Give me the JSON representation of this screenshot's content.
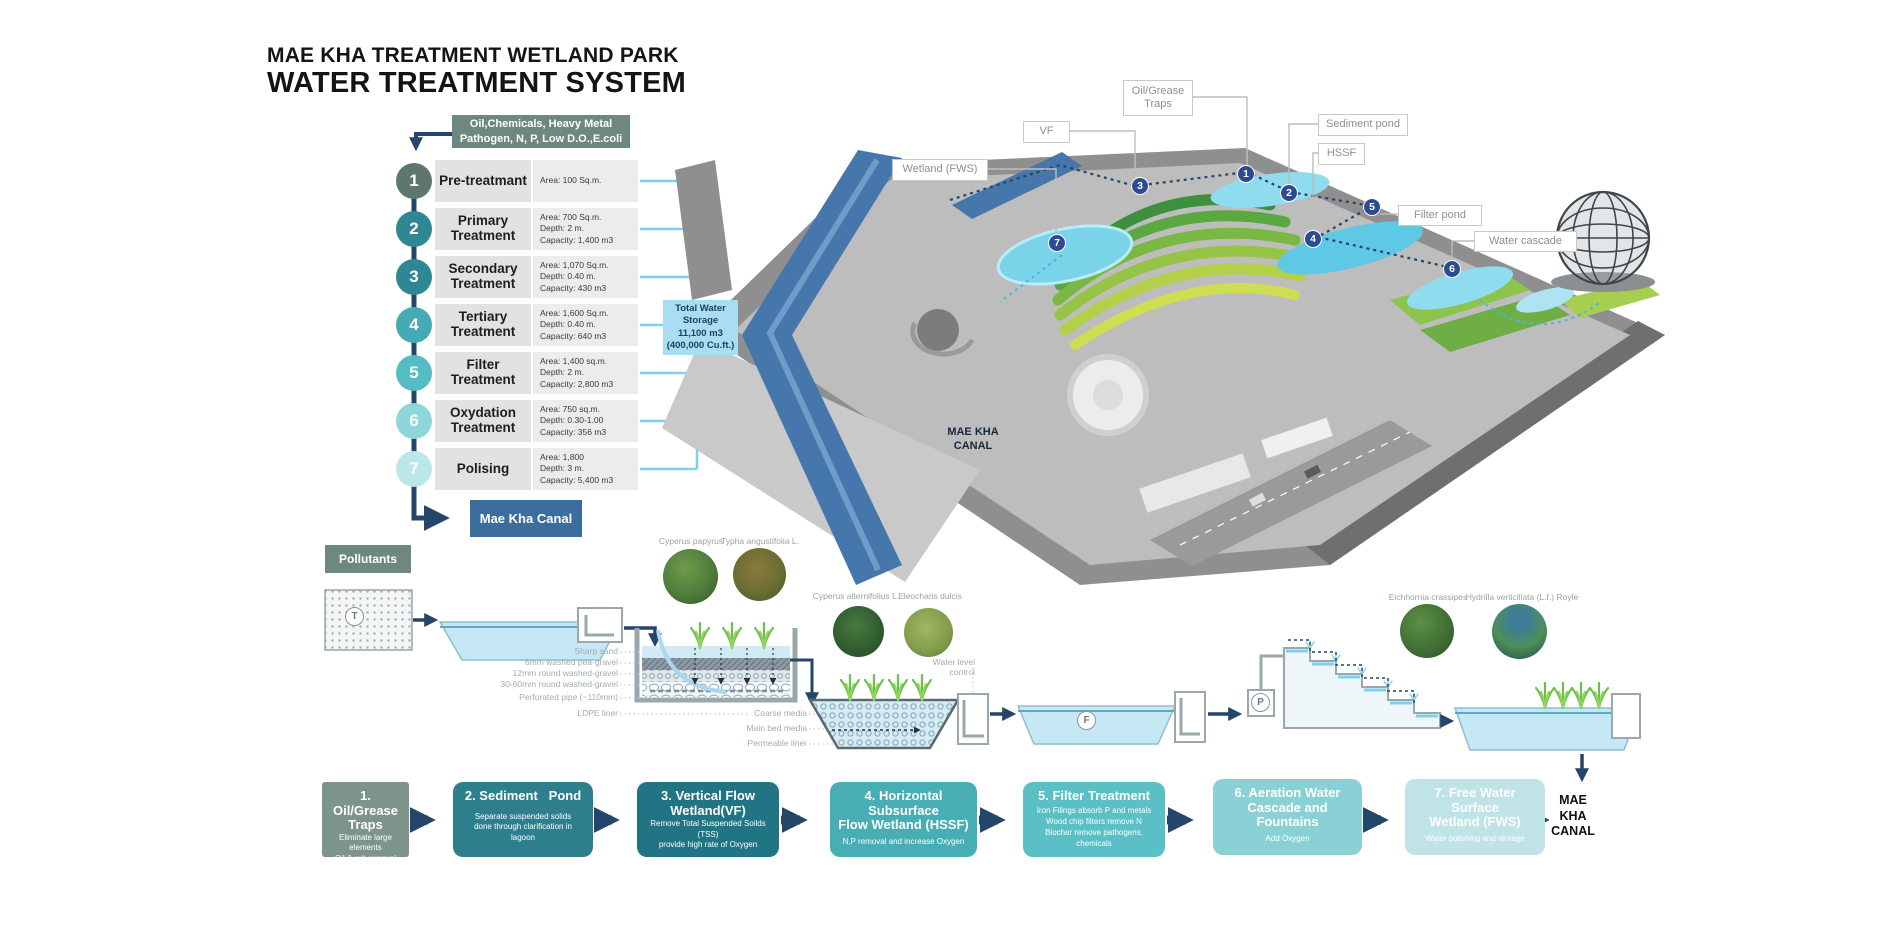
{
  "title": {
    "line1": "MAE KHA TREATMENT WETLAND PARK",
    "line2": "WATER TREATMENT SYSTEM"
  },
  "flowchart": {
    "input_box": "Oil,Chemicals, Heavy Metal\nPathogen, N, P, Low D.O.,E.coli",
    "steps": [
      {
        "num": "1",
        "name": "Pre-treatmant",
        "area": "Area: 100 Sq.m.",
        "depth": "",
        "capacity": "",
        "color": "#5e7670"
      },
      {
        "num": "2",
        "name": "Primary Treatment",
        "area": "Area: 700 Sq.m.",
        "depth": "Depth: 2 m.",
        "capacity": "Capacity: 1,400 m3",
        "color": "#2f8794"
      },
      {
        "num": "3",
        "name": "Secondary Treatment",
        "area": "Area: 1,070 Sq.m.",
        "depth": "Depth: 0.40 m.",
        "capacity": "Capacity: 430 m3",
        "color": "#2f8794"
      },
      {
        "num": "4",
        "name": "Tertiary Treatment",
        "area": "Area: 1,600 Sq.m.",
        "depth": "Depth: 0.40 m.",
        "capacity": "Capacity: 640 m3",
        "color": "#44aab4"
      },
      {
        "num": "5",
        "name": "Filter Treatment",
        "area": "Area: 1,400 sq.m.",
        "depth": "Depth: 2 m.",
        "capacity": "Capacity: 2,800 m3",
        "color": "#56bcc4"
      },
      {
        "num": "6",
        "name": "Oxydation Treatment",
        "area": "Area: 750 sq.m.",
        "depth": "Depth: 0.30-1.00",
        "capacity": "Capacity: 356 m3",
        "color": "#8fd6da"
      },
      {
        "num": "7",
        "name": "Polising",
        "area": "Area: 1,800",
        "depth": "Depth: 3 m.",
        "capacity": "Capacity: 5,400 m3",
        "color": "#bce7e9"
      }
    ],
    "total_box": "Total Water Storage\n11,100 m3\n(400,000 Cu.ft.)",
    "canal_box": "Mae Kha Canal",
    "pollutants_label": "Pollutants"
  },
  "map": {
    "callouts": {
      "oil": "Oil/Grease Traps",
      "vf": "VF",
      "wetland": "Wetland (FWS)",
      "sediment": "Sediment pond",
      "hssf": "HSSF",
      "filter": "Filter pond",
      "cascade": "Water cascade"
    },
    "canal_label": "MAE KHA\nCANAL",
    "markers": [
      "1",
      "2",
      "3",
      "4",
      "5",
      "6",
      "7"
    ]
  },
  "cross_section": {
    "plants": [
      {
        "name": "Cyperus papyrus"
      },
      {
        "name": "Typha angustifolia L."
      },
      {
        "name": "Cyperus alternifolius L."
      },
      {
        "name": "Eleocharis dulcis"
      },
      {
        "name": "Eichhornia crassipes"
      },
      {
        "name": "Hydrilla verticillata (L.f.) Royle"
      }
    ],
    "vf_layers": [
      "Sharp sand",
      "6mm washed pea-gravel",
      "12mm round washed-gravel",
      "30-60mm round washed-gravel",
      "Perforated pipe (~110mm)",
      "LDPE liner"
    ],
    "hssf_labels": {
      "water_level": "Water level control",
      "coarse": "Coarse media",
      "main_bed": "Main bed media",
      "permeable": "Permeable liner"
    },
    "markers": {
      "t": "T",
      "f": "F",
      "p": "P"
    }
  },
  "process_boxes": [
    {
      "title": "1. Oil/Grease\nTraps",
      "body": "Eliminate large elements\nOil & grit removal\nScreening",
      "color": "#7c948c"
    },
    {
      "title": "2. Sediment   Pond",
      "body": "Separate suspended solids\ndone through clarification in\nlagoon",
      "color": "#2d7f8e"
    },
    {
      "title": "3. Vertical Flow\nWetland(VF)",
      "body": "Remove Total Suspended Soilds (TSS)\nprovide high rate of Oxygen",
      "color": "#217483"
    },
    {
      "title": "4. Horizontal\nSubsurface\nFlow Wetland (HSSF)",
      "body": "N,P removal and increase Oxygen",
      "color": "#48aeb5"
    },
    {
      "title": "5. Filter Treatment",
      "body": "Iron Filings absorb P and metals\nWood chip filters remove N\nBiochar remove pathogens, chemicals",
      "color": "#5ac0c6"
    },
    {
      "title": "6. Aeration Water\nCascade and Fountains",
      "body": "Add Oxygen",
      "color": "#8ad1d5"
    },
    {
      "title": "7. Free Water Surface\nWetland (FWS)",
      "body": "Water polishing and storage",
      "color": "#bfe3e7"
    }
  ],
  "end_label": "MAE\nKHA\nCANAL"
}
